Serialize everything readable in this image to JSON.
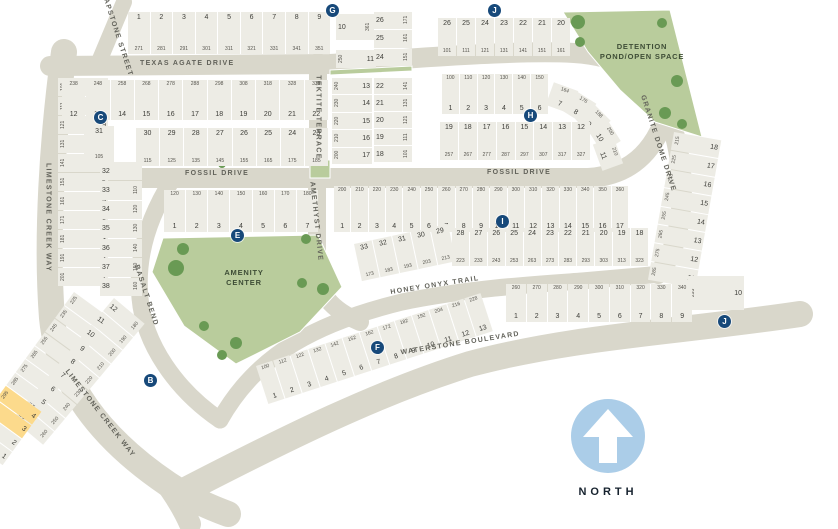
{
  "colors": {
    "road": "#d9d7cb",
    "lot_fill": "#edece5",
    "green_space": "#b9cc9c",
    "tree": "#699a54",
    "marker": "#17497a",
    "highlight_lot": "#fcda8c",
    "north_arrow_circle": "#abcde8"
  },
  "north": {
    "label": "NORTH"
  },
  "areas": {
    "detention": "DETENTION POND/OPEN SPACE",
    "amenity": "AMENITY CENTER"
  },
  "streets": {
    "soapstone": "SOAPSTONE STREET",
    "texas_agate": "TEXAS AGATE DRIVE",
    "limestone_upper": "LIMESTONE CREEK WAY",
    "limestone_lower": "LIMESTONE CREEK WAY",
    "fossil_left": "FOSSIL DRIVE",
    "fossil_right": "FOSSIL DRIVE",
    "tektite": "TEKTITE TERRACE",
    "amethyst": "AMETHYST DRIVE",
    "granite": "GRANITE DOME DRIVE",
    "basalt": "BASALT BEND",
    "honey": "HONEY ONYX TRAIL",
    "waterstone": "WATERSTONE BOULEVARD"
  },
  "markers": {
    "b": "B",
    "c": "C",
    "e": "E",
    "f": "F",
    "g": "G",
    "h": "H",
    "i": "I",
    "j": "J"
  },
  "lot_rows": [
    {
      "id": "tl_top",
      "lots": [
        {
          "n": "1",
          "a": "271"
        },
        {
          "n": "2",
          "a": "281"
        },
        {
          "n": "3",
          "a": "291"
        },
        {
          "n": "4",
          "a": "301"
        },
        {
          "n": "5",
          "a": "311"
        },
        {
          "n": "6",
          "a": "321"
        },
        {
          "n": "7",
          "a": "331"
        },
        {
          "n": "8",
          "a": "341"
        },
        {
          "n": "9",
          "a": "351"
        }
      ]
    },
    {
      "id": "tl_10",
      "lots": [
        {
          "n": "10",
          "a": "361"
        }
      ]
    },
    {
      "id": "tl_11",
      "lots": [
        {
          "n": "11",
          "a": "250"
        }
      ]
    },
    {
      "id": "tek_w",
      "lots": [
        {
          "n": "13",
          "a": "240"
        },
        {
          "n": "14",
          "a": "230"
        },
        {
          "n": "15",
          "a": "220"
        },
        {
          "n": "16",
          "a": "210"
        },
        {
          "n": "17",
          "a": "200"
        }
      ]
    },
    {
      "id": "tek_e1",
      "lots": [
        {
          "n": "26",
          "a": "171"
        },
        {
          "n": "25",
          "a": "161"
        },
        {
          "n": "24",
          "a": "151"
        }
      ]
    },
    {
      "id": "tek_e2",
      "lots": [
        {
          "n": "22",
          "a": "141"
        },
        {
          "n": "21",
          "a": "131"
        },
        {
          "n": "20",
          "a": "121"
        },
        {
          "n": "19",
          "a": "111"
        },
        {
          "n": "18",
          "a": "101"
        }
      ]
    },
    {
      "id": "lcw",
      "lots": [
        {
          "n": "11",
          "a": "101"
        },
        {
          "n": "10",
          "a": "111"
        },
        {
          "n": "9",
          "a": "121"
        },
        {
          "n": "8",
          "a": "131"
        },
        {
          "n": "7",
          "a": "141"
        },
        {
          "n": "6",
          "a": "151"
        },
        {
          "n": "5",
          "a": "161"
        },
        {
          "n": "4",
          "a": "171"
        },
        {
          "n": "3",
          "a": "181"
        },
        {
          "n": "2",
          "a": "191"
        },
        {
          "n": "1",
          "a": "201"
        }
      ]
    },
    {
      "id": "c_top",
      "lots": [
        {
          "n": "12",
          "a": "238"
        },
        {
          "n": "13",
          "a": "248"
        },
        {
          "n": "14",
          "a": "258"
        },
        {
          "n": "15",
          "a": "268"
        },
        {
          "n": "16",
          "a": "278"
        },
        {
          "n": "17",
          "a": "288"
        },
        {
          "n": "18",
          "a": "298"
        },
        {
          "n": "19",
          "a": "308"
        },
        {
          "n": "20",
          "a": "318"
        },
        {
          "n": "21",
          "a": "328"
        },
        {
          "n": "22",
          "a": "338"
        }
      ]
    },
    {
      "id": "c_31",
      "lots": [
        {
          "n": "31",
          "a": "105"
        }
      ]
    },
    {
      "id": "c_mid",
      "lots": [
        {
          "n": "30",
          "a": "115"
        },
        {
          "n": "29",
          "a": "125"
        },
        {
          "n": "28",
          "a": "135"
        },
        {
          "n": "27",
          "a": "145"
        },
        {
          "n": "26",
          "a": "155"
        },
        {
          "n": "25",
          "a": "165"
        },
        {
          "n": "24",
          "a": "175"
        },
        {
          "n": "23",
          "a": "185"
        }
      ]
    },
    {
      "id": "c_sw",
      "lots": [
        {
          "n": "32",
          "a": ""
        },
        {
          "n": "33",
          "a": "110"
        },
        {
          "n": "34",
          "a": "120"
        },
        {
          "n": "35",
          "a": "130"
        },
        {
          "n": "36",
          "a": "140"
        },
        {
          "n": "37",
          "a": "150"
        },
        {
          "n": "38",
          "a": "160"
        }
      ]
    },
    {
      "id": "e_row",
      "lots": [
        {
          "n": "1",
          "a": "120"
        },
        {
          "n": "2",
          "a": "130"
        },
        {
          "n": "3",
          "a": "140"
        },
        {
          "n": "4",
          "a": "150"
        },
        {
          "n": "5",
          "a": "160"
        },
        {
          "n": "6",
          "a": "170"
        },
        {
          "n": "7",
          "a": "180"
        }
      ]
    },
    {
      "id": "i_top",
      "lots": [
        {
          "n": "1",
          "a": "200"
        },
        {
          "n": "2",
          "a": "210"
        },
        {
          "n": "3",
          "a": "220"
        },
        {
          "n": "4",
          "a": "230"
        },
        {
          "n": "5",
          "a": "240"
        },
        {
          "n": "6",
          "a": "250"
        },
        {
          "n": "7",
          "a": "260"
        },
        {
          "n": "8",
          "a": "270"
        },
        {
          "n": "9",
          "a": "280"
        },
        {
          "n": "10",
          "a": "290"
        },
        {
          "n": "11",
          "a": "300"
        },
        {
          "n": "12",
          "a": "310"
        },
        {
          "n": "13",
          "a": "320"
        },
        {
          "n": "14",
          "a": "330"
        },
        {
          "n": "15",
          "a": "340"
        },
        {
          "n": "16",
          "a": "350"
        },
        {
          "n": "17",
          "a": "360"
        }
      ]
    },
    {
      "id": "i_bot_a",
      "lots": [
        {
          "n": "33",
          "a": "173"
        },
        {
          "n": "32",
          "a": "183"
        },
        {
          "n": "31",
          "a": "193"
        },
        {
          "n": "30",
          "a": "203"
        },
        {
          "n": "29",
          "a": "213"
        }
      ]
    },
    {
      "id": "i_bot_b",
      "lots": [
        {
          "n": "28",
          "a": "223"
        },
        {
          "n": "27",
          "a": "233"
        },
        {
          "n": "26",
          "a": "243"
        },
        {
          "n": "25",
          "a": "253"
        },
        {
          "n": "24",
          "a": "263"
        },
        {
          "n": "23",
          "a": "273"
        },
        {
          "n": "22",
          "a": "283"
        },
        {
          "n": "21",
          "a": "293"
        },
        {
          "n": "20",
          "a": "303"
        },
        {
          "n": "19",
          "a": "313"
        },
        {
          "n": "18",
          "a": "323"
        }
      ]
    },
    {
      "id": "h_top",
      "lots": [
        {
          "n": "1",
          "a": "100"
        },
        {
          "n": "2",
          "a": "110"
        },
        {
          "n": "3",
          "a": "120"
        },
        {
          "n": "4",
          "a": "130"
        },
        {
          "n": "5",
          "a": "140"
        },
        {
          "n": "6",
          "a": "150"
        }
      ]
    },
    {
      "id": "h_7",
      "lots": [
        {
          "n": "7",
          "a": "164"
        }
      ]
    },
    {
      "id": "h_8",
      "lots": [
        {
          "n": "8",
          "a": "176"
        }
      ]
    },
    {
      "id": "h_9",
      "lots": [
        {
          "n": "9",
          "a": "188"
        }
      ]
    },
    {
      "id": "h_10",
      "lots": [
        {
          "n": "10",
          "a": "200"
        }
      ]
    },
    {
      "id": "h_11",
      "lots": [
        {
          "n": "11",
          "a": "210"
        }
      ]
    },
    {
      "id": "h_bot",
      "lots": [
        {
          "n": "19",
          "a": "257"
        },
        {
          "n": "18",
          "a": "267"
        },
        {
          "n": "17",
          "a": "277"
        },
        {
          "n": "16",
          "a": "287"
        },
        {
          "n": "15",
          "a": "297"
        },
        {
          "n": "14",
          "a": "307"
        },
        {
          "n": "13",
          "a": "317"
        },
        {
          "n": "12",
          "a": "327"
        }
      ]
    },
    {
      "id": "j_top",
      "lots": [
        {
          "n": "26",
          "a": "101"
        },
        {
          "n": "25",
          "a": "111"
        },
        {
          "n": "24",
          "a": "121"
        },
        {
          "n": "23",
          "a": "131"
        },
        {
          "n": "22",
          "a": "141"
        },
        {
          "n": "21",
          "a": "151"
        },
        {
          "n": "20",
          "a": "161"
        }
      ]
    },
    {
      "id": "j_col",
      "lots": [
        {
          "n": "18",
          "a": "215"
        },
        {
          "n": "17",
          "a": "225"
        },
        {
          "n": "16",
          "a": "235"
        },
        {
          "n": "15",
          "a": "245"
        },
        {
          "n": "14",
          "a": "255"
        },
        {
          "n": "13",
          "a": "265"
        },
        {
          "n": "12",
          "a": "275"
        },
        {
          "n": "11",
          "a": "285"
        }
      ]
    },
    {
      "id": "j_10",
      "lots": [
        {
          "n": "10",
          "a": "295"
        }
      ]
    },
    {
      "id": "j_row",
      "lots": [
        {
          "n": "1",
          "a": "260"
        },
        {
          "n": "2",
          "a": "270"
        },
        {
          "n": "3",
          "a": "280"
        },
        {
          "n": "4",
          "a": "290"
        },
        {
          "n": "5",
          "a": "300"
        },
        {
          "n": "6",
          "a": "310"
        },
        {
          "n": "7",
          "a": "320"
        },
        {
          "n": "8",
          "a": "330"
        },
        {
          "n": "9",
          "a": "340"
        }
      ]
    },
    {
      "id": "f_row",
      "lots": [
        {
          "n": "1",
          "a": "100"
        },
        {
          "n": "2",
          "a": "112"
        },
        {
          "n": "3",
          "a": "122"
        },
        {
          "n": "4",
          "a": "132"
        },
        {
          "n": "5",
          "a": "142"
        },
        {
          "n": "6",
          "a": "152"
        },
        {
          "n": "7",
          "a": "162"
        },
        {
          "n": "8",
          "a": "172"
        },
        {
          "n": "9",
          "a": "182"
        },
        {
          "n": "10",
          "a": "192"
        },
        {
          "n": "11",
          "a": "204"
        },
        {
          "n": "12",
          "a": "216"
        },
        {
          "n": "13",
          "a": "228"
        }
      ]
    },
    {
      "id": "b_east",
      "lots": [
        {
          "n": "12",
          "a": "180"
        },
        {
          "n": "13",
          "a": "190"
        },
        {
          "n": "14",
          "a": "200"
        },
        {
          "n": "15",
          "a": "210"
        },
        {
          "n": "16",
          "a": "220"
        },
        {
          "n": "17",
          "a": "230"
        },
        {
          "n": "18",
          "a": "240"
        },
        {
          "n": "19",
          "a": "250"
        },
        {
          "n": "20",
          "a": "260"
        }
      ]
    },
    {
      "id": "b_west",
      "lots": [
        {
          "n": "11",
          "a": "225"
        },
        {
          "n": "10",
          "a": "235"
        },
        {
          "n": "9",
          "a": "245"
        },
        {
          "n": "8",
          "a": "255"
        },
        {
          "n": "7",
          "a": "265"
        },
        {
          "n": "6",
          "a": "275"
        },
        {
          "n": "5",
          "a": "285"
        },
        {
          "n": "4",
          "a": "295",
          "hl": true
        },
        {
          "n": "3",
          "a": "305",
          "hl": true
        },
        {
          "n": "2",
          "a": "315"
        },
        {
          "n": "1",
          "a": "325"
        }
      ]
    }
  ]
}
